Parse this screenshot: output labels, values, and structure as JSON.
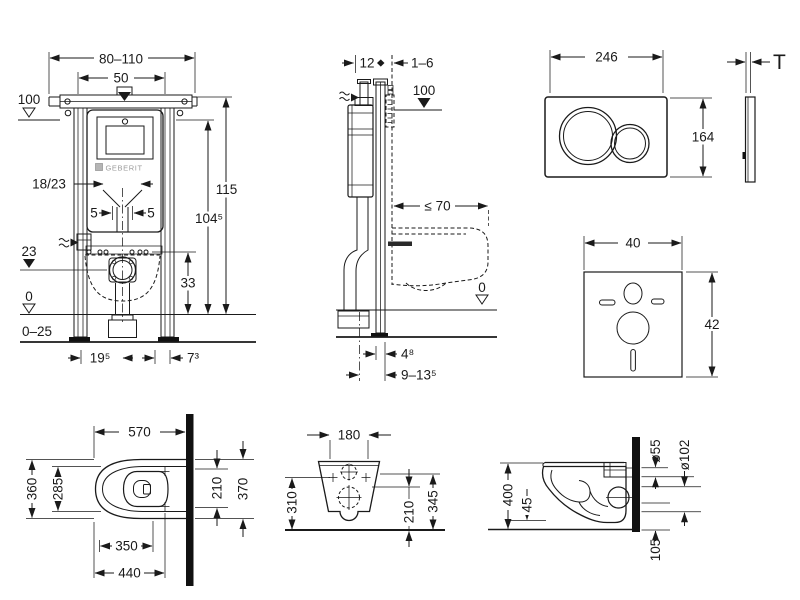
{
  "views": {
    "frame_front": {
      "width_range": "80–110",
      "rail_spacing": "50",
      "level_height": "100",
      "dim_18_23": "18/23",
      "offset_left": "5",
      "offset_right": "5",
      "level_23": "23",
      "outlet_height": "33",
      "frame_height": "115",
      "frame_height_inner": "104⁵",
      "level_zero": "0",
      "foot_range": "0–25",
      "dim_19_5": "19⁵",
      "dim_7_3": "7³",
      "brand": "GEBERIT"
    },
    "frame_side": {
      "depth": "12",
      "wall_gap": "1–6",
      "level_height": "100",
      "bowl_depth_max": "≤ 70",
      "level_zero": "0",
      "dim_4_8": "4⁸",
      "dim_9_13_5": "9–13⁵"
    },
    "flush_plate": {
      "width": "246",
      "height": "164",
      "thickness": "T"
    },
    "sound_mat": {
      "width": "40",
      "height": "42"
    },
    "toilet_top": {
      "depth": "570",
      "width": "360",
      "inner_width": "285",
      "dim_350": "350",
      "dim_440": "440",
      "dim_210": "210",
      "dim_370": "370"
    },
    "toilet_rear": {
      "width": "180",
      "dim_310": "310",
      "dim_210": "210",
      "dim_345": "345"
    },
    "toilet_side": {
      "height": "400",
      "dim_45": "45",
      "inlet_diameter": "ø55",
      "outlet_diameter": "ø102",
      "dim_105": "105"
    }
  }
}
